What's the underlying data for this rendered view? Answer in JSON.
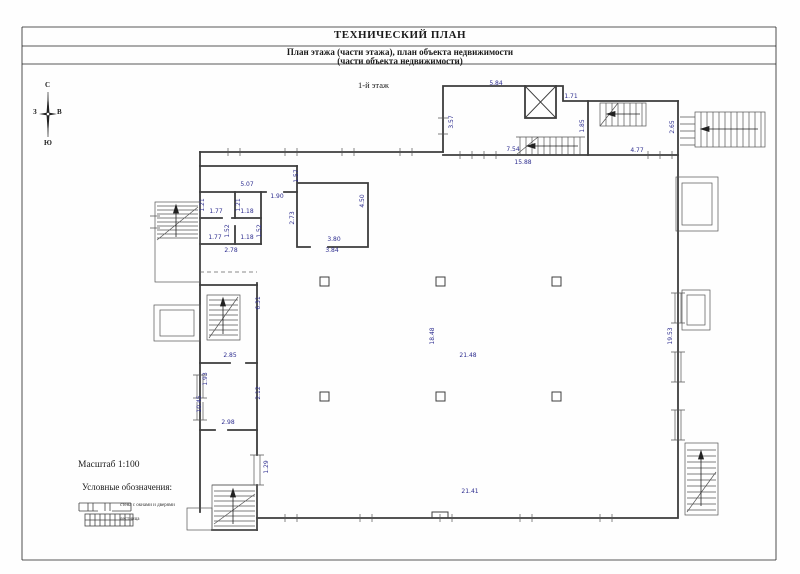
{
  "header": {
    "title": "ТЕХНИЧЕСКИЙ ПЛАН",
    "subtitle1": "План этажа (части этажа), план объекта недвижимости",
    "subtitle2": "(части объекта недвижимости)"
  },
  "compass": {
    "north": "С",
    "south": "Ю",
    "west": "З",
    "east": "В"
  },
  "plan": {
    "floor_label": "1-й этаж",
    "dimensions": [
      {
        "text": "5.84",
        "x": 496,
        "y": 84
      },
      {
        "text": "1.71",
        "x": 571,
        "y": 97
      },
      {
        "text": "3.57",
        "x": 452,
        "y": 122,
        "rot": 1
      },
      {
        "text": "1.85",
        "x": 583,
        "y": 126,
        "rot": 1
      },
      {
        "text": "2.65",
        "x": 673,
        "y": 127,
        "rot": 1
      },
      {
        "text": "7.54",
        "x": 513,
        "y": 150
      },
      {
        "text": "15.88",
        "x": 523,
        "y": 163
      },
      {
        "text": "4.77",
        "x": 637,
        "y": 151
      },
      {
        "text": "5.07",
        "x": 247,
        "y": 185
      },
      {
        "text": "1.57",
        "x": 297,
        "y": 176,
        "rot": 1
      },
      {
        "text": "1.90",
        "x": 277,
        "y": 197
      },
      {
        "text": "1.21",
        "x": 203,
        "y": 205,
        "rot": 1
      },
      {
        "text": "1.21",
        "x": 239,
        "y": 205,
        "rot": 1
      },
      {
        "text": "1.77",
        "x": 216,
        "y": 212
      },
      {
        "text": "1.18",
        "x": 247,
        "y": 212
      },
      {
        "text": "1.52",
        "x": 228,
        "y": 231,
        "rot": 1
      },
      {
        "text": "1.52",
        "x": 260,
        "y": 231,
        "rot": 1
      },
      {
        "text": "1.77",
        "x": 215,
        "y": 238
      },
      {
        "text": "1.18",
        "x": 247,
        "y": 238
      },
      {
        "text": "2.78",
        "x": 231,
        "y": 251
      },
      {
        "text": "2.73",
        "x": 293,
        "y": 218,
        "rot": 1
      },
      {
        "text": "4.50",
        "x": 363,
        "y": 201,
        "rot": 1
      },
      {
        "text": "3.80",
        "x": 334,
        "y": 240
      },
      {
        "text": "3.84",
        "x": 332,
        "y": 251
      },
      {
        "text": "6.31",
        "x": 259,
        "y": 303,
        "rot": 1
      },
      {
        "text": "2.85",
        "x": 230,
        "y": 356
      },
      {
        "text": "1.93",
        "x": 206,
        "y": 379,
        "rot": 1
      },
      {
        "text": "2.12",
        "x": 259,
        "y": 393,
        "rot": 1
      },
      {
        "text": "10.45",
        "x": 200,
        "y": 404,
        "rot": 1
      },
      {
        "text": "2.98",
        "x": 228,
        "y": 423
      },
      {
        "text": "1.29",
        "x": 267,
        "y": 467,
        "rot": 1
      },
      {
        "text": "18.48",
        "x": 433,
        "y": 336,
        "rot": 1
      },
      {
        "text": "21.48",
        "x": 468,
        "y": 356
      },
      {
        "text": "21.41",
        "x": 470,
        "y": 492
      },
      {
        "text": "19.53",
        "x": 671,
        "y": 336,
        "rot": 1
      }
    ]
  },
  "footer": {
    "scale_label": "Масштаб 1:100",
    "legend_title": "Условные обозначения:",
    "legend": [
      {
        "symbol": "wall-with-window-and-door",
        "label": "стена с окнами и дверями"
      },
      {
        "symbol": "staircase",
        "label": "лестница"
      }
    ]
  },
  "colors": {
    "dimension_text": "#2d2d8f",
    "wall_line": "#3d3d3d",
    "frame_line": "#222222"
  }
}
